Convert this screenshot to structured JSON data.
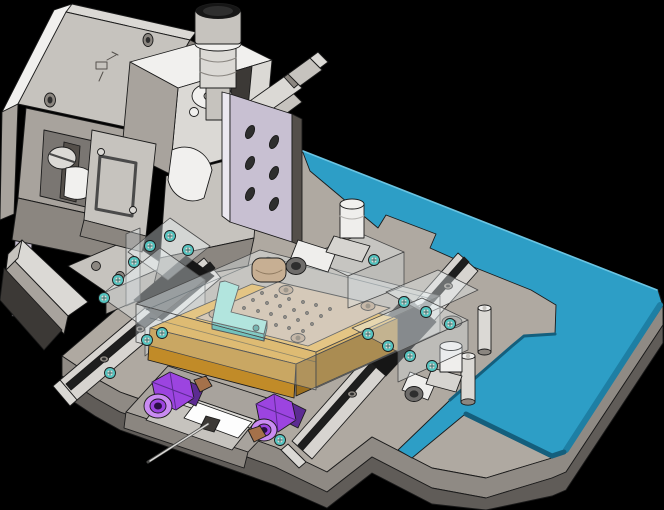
{
  "meta": {
    "description": "Isometric 3D CAD render of a precision assembly / alignment fixture on a stepped base plate",
    "background": "#000000",
    "view": "isometric"
  },
  "palette": {
    "bg": "#000000",
    "edge": "#1B1B1B",
    "baseTop": "#AFA9A1",
    "baseSide": "#8F8A84",
    "baseLower": "#605C58",
    "baseDark": "#3C3936",
    "steelWhite": "#F1F0EE",
    "steelLight": "#DBD9D5",
    "steelMid": "#C6C3BE",
    "steelGray": "#A8A39D",
    "steelShadow": "#8B8680",
    "recess": "#7A7672",
    "lavender": "#C8C0D2",
    "lavenderLight": "#EBE8F0",
    "lavenderShadow": "#544F4A",
    "tealTop": "#2D9EC6",
    "tealSide": "#1E7FA4",
    "tealDark": "#145F7D",
    "tealHighlight": "#6AC4E2",
    "orangeTop": "#DFA83E",
    "orangeSide": "#C18B28",
    "orangeDark": "#9C6F1E",
    "tan": "#C7AF93",
    "tanRing": "#AE9478",
    "tanDark": "#6F5F4C",
    "mint": "#8FDCCF",
    "mintDark": "#43B2A6",
    "mintScrew": "#2F8F86",
    "screwTeal": "#54C4C0",
    "purple": "#9C44E0",
    "purpleLight": "#C98BF2",
    "purpleDark": "#5C2B92",
    "purpleDeep": "#2A0F45",
    "copper": "#A5714A",
    "railLight": "#D7D4D0",
    "railDark": "#1E1E1E",
    "black": "#161616",
    "glassTop": "rgba(236,244,248,0.38)",
    "glassFront": "rgba(222,233,238,0.30)",
    "glassSide": "rgba(214,226,232,0.26)",
    "white": "#FDFDFD",
    "needle": "#D9D8D6",
    "holeDark": "#2E2E2E",
    "fittingWhite": "#EFEEEC",
    "fittingShade": "#D6D4D0",
    "fittingDark": "#6E6C6A"
  },
  "parts": [
    {
      "id": "base-plate",
      "label": "Gray machined base plate",
      "color": "baseTop"
    },
    {
      "id": "teal-mounting-plate",
      "label": "Teal stepped top mounting plate",
      "color": "tealTop"
    },
    {
      "id": "left-backing-plate",
      "label": "Large vertical backing plate",
      "color": "steelMid"
    },
    {
      "id": "lavender-plate",
      "label": "Lavender vertical adapter plate with oval slots",
      "color": "lavender"
    },
    {
      "id": "xyz-stage",
      "label": "Manual XYZ positioning stage",
      "color": "steelLight"
    },
    {
      "id": "vertical-micrometer",
      "label": "Vertical micrometer head with black cap",
      "color": "steelMid"
    },
    {
      "id": "angled-micrometer",
      "label": "Angled micrometer head",
      "color": "steelLight"
    },
    {
      "id": "wedge-block",
      "label": "Triangular wedge support block",
      "color": "steelLight"
    },
    {
      "id": "linear-rail-left",
      "label": "Left linear guide rail",
      "color": "railLight"
    },
    {
      "id": "linear-rail-right",
      "label": "Right linear guide rail",
      "color": "railLight"
    },
    {
      "id": "rail-carriage",
      "label": "Black rail carriage block",
      "color": "black"
    },
    {
      "id": "orange-block",
      "label": "Amber heater / carrier block",
      "color": "orangeTop"
    },
    {
      "id": "vacuum-chuck",
      "label": "Tan perforated vacuum chuck plate",
      "color": "tan"
    },
    {
      "id": "mint-clamp",
      "label": "Mint L-shaped clamp arm",
      "color": "mint"
    },
    {
      "id": "glass-cover",
      "label": "Transparent cover / clamp blocks",
      "color": "glassTop"
    },
    {
      "id": "pneumatic-fitting-top",
      "label": "Push-in pneumatic elbow fitting (top)",
      "color": "fittingWhite"
    },
    {
      "id": "pneumatic-fitting-bottom",
      "label": "Push-in pneumatic elbow fitting (bottom)",
      "color": "fittingWhite"
    },
    {
      "id": "standoff-pin",
      "label": "Cylindrical standoff pins (x2)",
      "color": "steelLight"
    },
    {
      "id": "purple-thumb-screw",
      "label": "Purple hex thumb screws (x2)",
      "color": "purple"
    },
    {
      "id": "sensor-box",
      "label": "Sensor box with white label face",
      "color": "steelMid"
    },
    {
      "id": "needle-probe",
      "label": "Dispense needle / probe",
      "color": "needle"
    },
    {
      "id": "teal-screws",
      "label": "Cap screws with teal captive washers",
      "color": "screwTeal"
    }
  ],
  "counts": {
    "teal_washer_screws": 19,
    "lavender_oval_slots": 6,
    "chuck_vacuum_holes": 24,
    "standoff_pins": 2,
    "purple_knobs": 2,
    "pneumatic_fittings": 2,
    "linear_rails": 2
  }
}
